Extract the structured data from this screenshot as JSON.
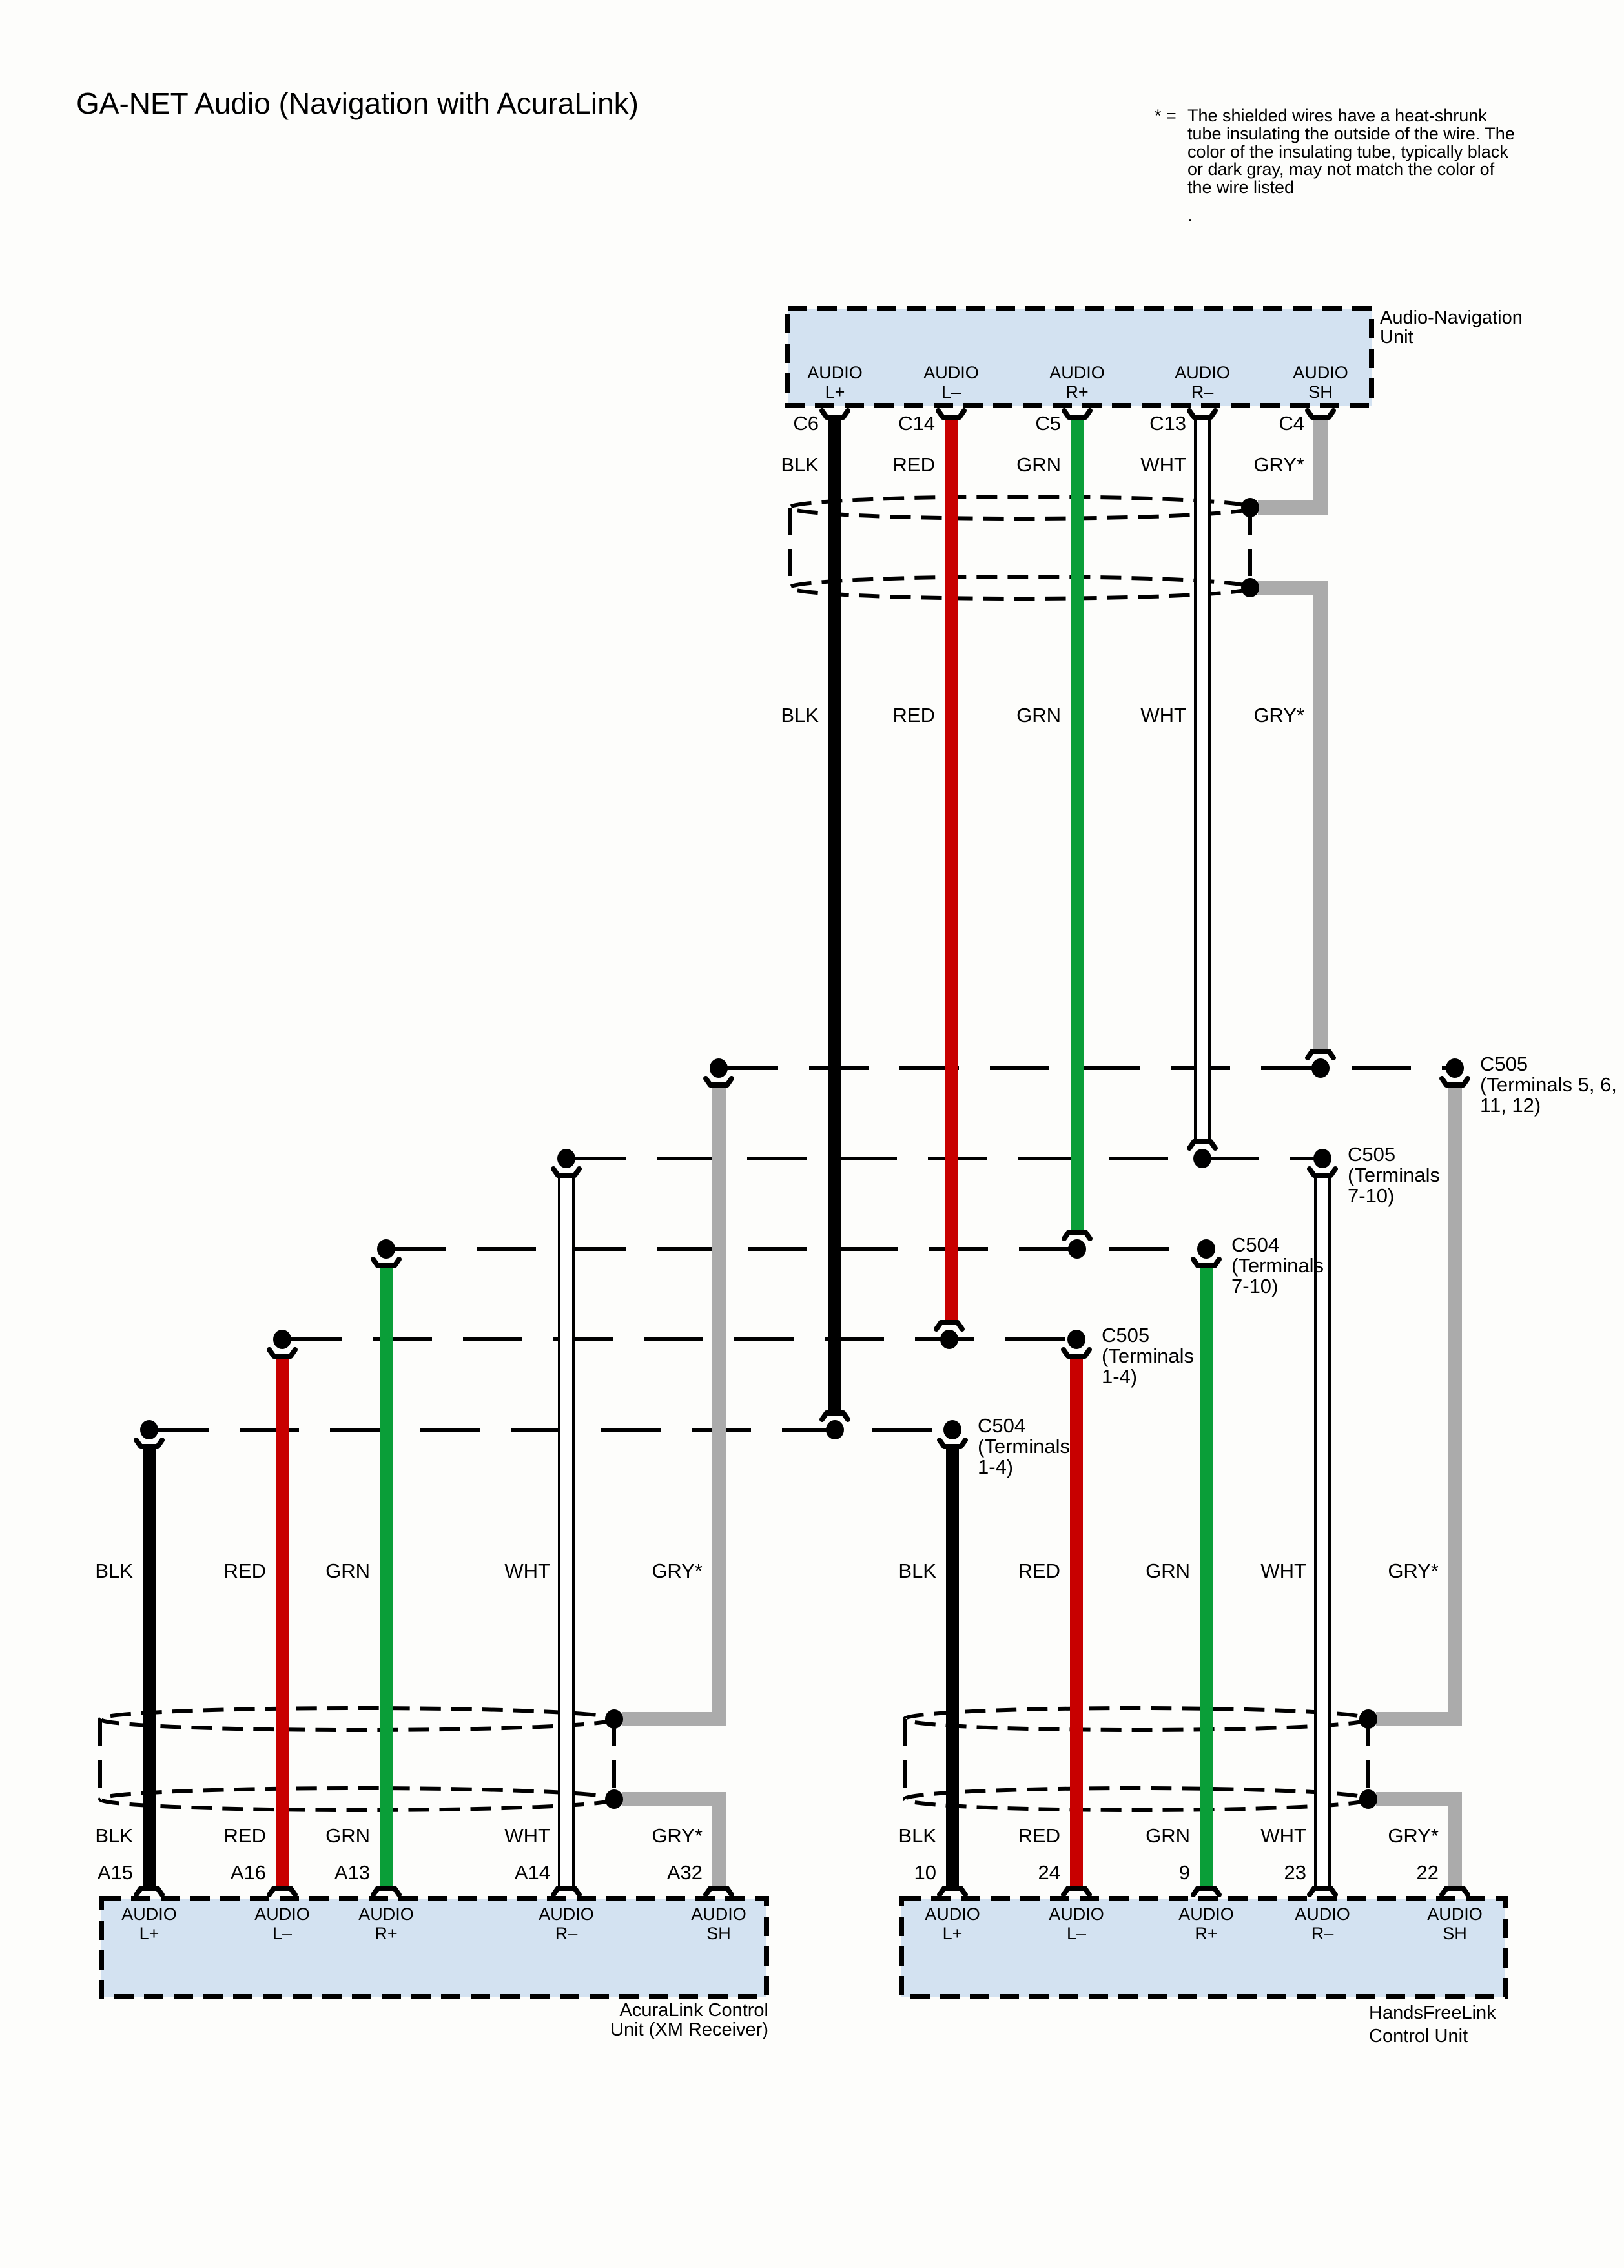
{
  "title": "GA-NET Audio (Navigation with AcuraLink)",
  "note": {
    "prefix": "* =",
    "lines": [
      "The shielded wires have a heat-shrunk",
      "tube insulating the outside of the wire. The",
      "color of the insulating tube, typically black",
      "or dark gray, may not match the color of",
      "the wire listed",
      "."
    ]
  },
  "colors": {
    "wire_black": "#000000",
    "wire_red": "#c80000",
    "wire_green": "#0a9e38",
    "wire_gray": "#ababab",
    "wire_white": "#ffffff",
    "unit_fill": "#d3e2f1",
    "line": "#000000"
  },
  "nav_unit": {
    "caption": [
      "Audio-Navigation",
      "Unit"
    ],
    "connectors": [
      "C6",
      "C14",
      "C5",
      "C13",
      "C4"
    ],
    "wire_colors": [
      "BLK",
      "RED",
      "GRN",
      "WHT",
      "GRY*"
    ],
    "pins": [
      {
        "l1": "AUDIO",
        "l2": "L+"
      },
      {
        "l1": "AUDIO",
        "l2": "L–"
      },
      {
        "l1": "AUDIO",
        "l2": "R+"
      },
      {
        "l1": "AUDIO",
        "l2": "R–"
      },
      {
        "l1": "AUDIO",
        "l2": "SH"
      }
    ]
  },
  "mid_wire_colors": [
    "BLK",
    "RED",
    "GRN",
    "WHT",
    "GRY*"
  ],
  "junctions": [
    {
      "lines": [
        "C505",
        "(Terminals 5, 6,",
        "11, 12)"
      ]
    },
    {
      "lines": [
        "C505",
        "(Terminals",
        "7-10)"
      ]
    },
    {
      "lines": [
        "C504",
        "(Terminals",
        "7-10)"
      ]
    },
    {
      "lines": [
        "C505",
        "(Terminals",
        "1-4)"
      ]
    },
    {
      "lines": [
        "C504",
        "(Terminals",
        "1-4)"
      ]
    }
  ],
  "acuralink_unit": {
    "caption": [
      "AcuraLink Control",
      "Unit (XM Receiver)"
    ],
    "wire_colors_upper": [
      "BLK",
      "RED",
      "GRN",
      "WHT",
      "GRY*"
    ],
    "wire_colors_lower": [
      "BLK",
      "RED",
      "GRN",
      "WHT",
      "GRY*"
    ],
    "terminals": [
      "A15",
      "A16",
      "A13",
      "A14",
      "A32"
    ],
    "pins": [
      {
        "l1": "AUDIO",
        "l2": "L+"
      },
      {
        "l1": "AUDIO",
        "l2": "L–"
      },
      {
        "l1": "AUDIO",
        "l2": "R+"
      },
      {
        "l1": "AUDIO",
        "l2": "R–"
      },
      {
        "l1": "AUDIO",
        "l2": "SH"
      }
    ]
  },
  "handsfree_unit": {
    "caption": [
      "HandsFreeLink",
      "Control Unit"
    ],
    "wire_colors_upper": [
      "BLK",
      "RED",
      "GRN",
      "WHT",
      "GRY*"
    ],
    "wire_colors_lower": [
      "BLK",
      "RED",
      "GRN",
      "WHT",
      "GRY*"
    ],
    "terminals": [
      "10",
      "24",
      "9",
      "23",
      "22"
    ],
    "pins": [
      {
        "l1": "AUDIO",
        "l2": "L+"
      },
      {
        "l1": "AUDIO",
        "l2": "L–"
      },
      {
        "l1": "AUDIO",
        "l2": "R+"
      },
      {
        "l1": "AUDIO",
        "l2": "R–"
      },
      {
        "l1": "AUDIO",
        "l2": "SH"
      }
    ]
  }
}
